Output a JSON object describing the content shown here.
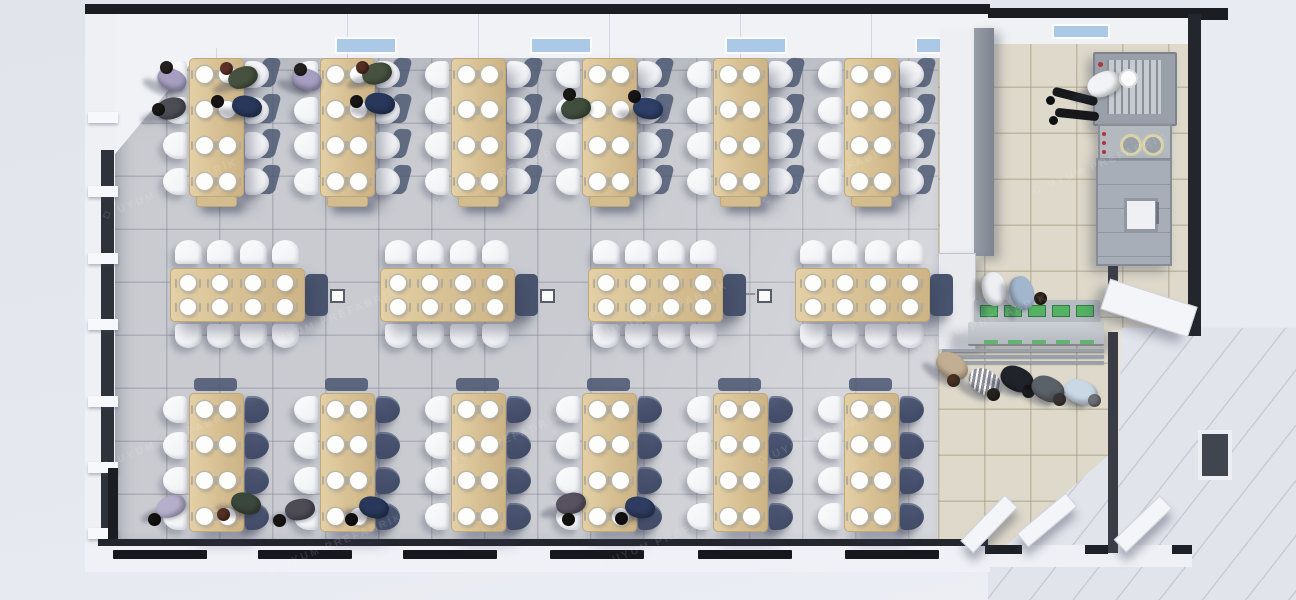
{
  "scene": {
    "title": "Prefabricated cafeteria dining hall — top-down 3D render",
    "watermark": {
      "text": "UYUM PREFABRİK",
      "logo_glyph": "◇",
      "opacity": 0.34
    },
    "colors": {
      "background": "#e4e6ee",
      "wall_dark": "#1b1d23",
      "partition_gray": "#8d929c",
      "floor_dining": "#c9cbd1",
      "floor_service": "#ded9ca",
      "table_wood": "#d8c297",
      "chair_white": "#f6f8fa",
      "chair_shadow_navy": "#49556f",
      "plate_white": "#fdfdfc",
      "window_glass_blue": "#abc9e6",
      "glass_dark": "#2e333b",
      "steel_gray": "#a7acb5",
      "tray_green": "#55b264",
      "exterior_white": "#f1f2f6"
    },
    "dining_rows": {
      "top": {
        "tables": 6,
        "left0": 189,
        "spacing": 131,
        "top": 58,
        "w": 53,
        "h": 137,
        "plate_rows": 4,
        "seats_per_table": 8
      },
      "bottom": {
        "tables": 6,
        "left0": 189,
        "spacing": 131,
        "top": 393,
        "w": 53,
        "h": 137,
        "plate_rows": 4,
        "seats_per_table": 8
      },
      "middle": {
        "tables": 4,
        "lefts": [
          170,
          380,
          588,
          795
        ],
        "top": 268,
        "w": 133,
        "h": 52,
        "plate_cols": 4,
        "seats_per_table": 8
      }
    },
    "floor_boxes": [
      {
        "x": 330,
        "y": 289
      },
      {
        "x": 540,
        "y": 289
      },
      {
        "x": 757,
        "y": 289
      }
    ],
    "top_windows": [
      335,
      530,
      725,
      915
    ],
    "kitchen_top_window": 1052,
    "bottom_windows": [
      160,
      305,
      450,
      597,
      745,
      892
    ],
    "left_sills": [
      112,
      186,
      253,
      319,
      396,
      462,
      528
    ],
    "people_seated": [
      {
        "x": 172,
        "y": 79,
        "rot": 25,
        "body": "#a79fc2",
        "head": "#26221f",
        "hx": -6,
        "hy": -12
      },
      {
        "x": 171,
        "y": 108,
        "rot": -15,
        "body": "#4c4c55",
        "head": "#1b1917",
        "hx": -13,
        "hy": 1
      },
      {
        "x": 243,
        "y": 77,
        "rot": -20,
        "body": "#46523f",
        "head": "#5c3126",
        "hx": -17,
        "hy": -9
      },
      {
        "x": 247,
        "y": 106,
        "rot": 12,
        "body": "#28375a",
        "head": "#171515",
        "hx": -30,
        "hy": -5
      },
      {
        "x": 307,
        "y": 79,
        "rot": 20,
        "body": "#a79fc2",
        "head": "#26221f",
        "hx": -7,
        "hy": -10
      },
      {
        "x": 377,
        "y": 73,
        "rot": -15,
        "body": "#46523f",
        "head": "#532d22",
        "hx": -15,
        "hy": -6
      },
      {
        "x": 380,
        "y": 103,
        "rot": 8,
        "body": "#28375a",
        "head": "#171515",
        "hx": -24,
        "hy": -2
      },
      {
        "x": 576,
        "y": 108,
        "rot": -10,
        "body": "#414d3d",
        "head": "#1b1917",
        "hx": -7,
        "hy": -14
      },
      {
        "x": 648,
        "y": 108,
        "rot": 10,
        "body": "#2d3f66",
        "head": "#171515",
        "hx": -14,
        "hy": -12
      },
      {
        "x": 171,
        "y": 506,
        "rot": -20,
        "body": "#b6afcc",
        "head": "#14120e",
        "hx": -17,
        "hy": 13
      },
      {
        "x": 246,
        "y": 503,
        "rot": 15,
        "body": "#3a473b",
        "head": "#522e23",
        "hx": -23,
        "hy": 11
      },
      {
        "x": 300,
        "y": 509,
        "rot": -10,
        "body": "#4c4b56",
        "head": "#181613",
        "hx": -21,
        "hy": 11
      },
      {
        "x": 374,
        "y": 507,
        "rot": 15,
        "body": "#28375a",
        "head": "#111111",
        "hx": -23,
        "hy": 12
      },
      {
        "x": 571,
        "y": 503,
        "rot": -12,
        "body": "#585160",
        "head": "#14120e",
        "hx": -3,
        "hy": 16
      },
      {
        "x": 640,
        "y": 507,
        "rot": 12,
        "body": "#2d3c60",
        "head": "#111111",
        "hx": -19,
        "hy": 11
      }
    ],
    "people_queue": [
      {
        "x": 952,
        "y": 366,
        "rot": 35,
        "body": "#c1ae93",
        "head": "#4c301f",
        "hx": 1,
        "hy": 14
      },
      {
        "x": 985,
        "y": 382,
        "rot": 30,
        "body": "#90909a",
        "head": "#25211d",
        "hx": 8,
        "hy": 12,
        "pattern": "stripes"
      },
      {
        "x": 1017,
        "y": 379,
        "rot": 25,
        "body": "#20232a",
        "head": "#14120e",
        "hx": 11,
        "hy": 12
      },
      {
        "x": 1048,
        "y": 389,
        "rot": 25,
        "body": "#5b6169",
        "head": "#3b342c",
        "hx": 11,
        "hy": 10
      },
      {
        "x": 1081,
        "y": 392,
        "rot": 20,
        "body": "#cad7e5",
        "head": "#6c7076",
        "hx": 13,
        "hy": 8
      }
    ],
    "staff": {
      "chef": {
        "x": 1104,
        "y": 84,
        "rot": -24,
        "body": "#f2f3f6",
        "head": "#fbfbfc",
        "hx": 22,
        "hy": -8,
        "hat": true
      },
      "servers": [
        {
          "x": 994,
          "y": 289,
          "rot": 80,
          "body": "#edeff3",
          "head": "#f7f7f8",
          "hx": 20,
          "hy": 6,
          "hat": true
        },
        {
          "x": 1022,
          "y": 293,
          "rot": 75,
          "body": "#a2b6cd",
          "head": "#2b2219",
          "hx": 18,
          "hy": 5
        }
      ]
    },
    "serving": {
      "tray_count": 5,
      "rail_lines": 3
    },
    "kitchen_equipment": [
      {
        "name": "exhaust-grill-unit"
      },
      {
        "name": "cooktop-range"
      },
      {
        "name": "oven-cabinet"
      }
    ],
    "doors_bottom": [
      {
        "cx": 988,
        "cy": 523,
        "rot": -46
      },
      {
        "cx": 1046,
        "cy": 519,
        "rot": -40
      },
      {
        "cx": 1142,
        "cy": 523,
        "rot": -44
      }
    ],
    "door_side": {
      "cx": 1148,
      "cy": 307,
      "rot": 18
    },
    "watermark_tiles": [
      [
        95,
        165
      ],
      [
        425,
        150
      ],
      [
        755,
        150
      ],
      [
        1025,
        140
      ],
      [
        255,
        295
      ],
      [
        585,
        288
      ],
      [
        905,
        300
      ],
      [
        95,
        415
      ],
      [
        420,
        420
      ],
      [
        750,
        410
      ],
      [
        260,
        520
      ],
      [
        590,
        515
      ]
    ]
  }
}
